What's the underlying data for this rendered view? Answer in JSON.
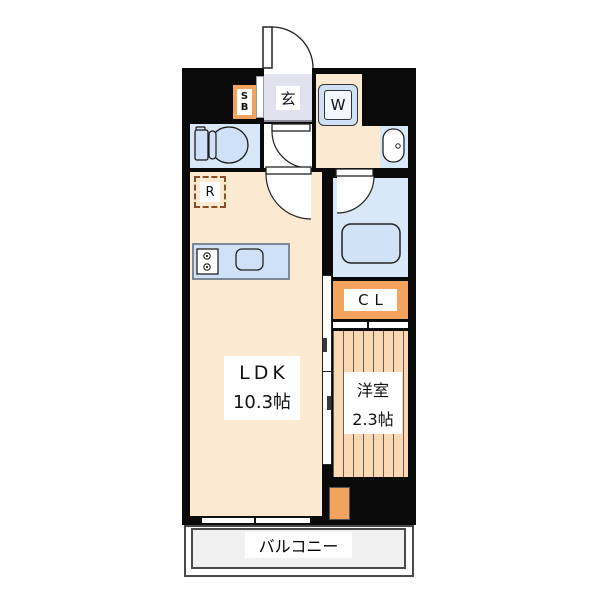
{
  "plan": {
    "type": "apartment-floor-plan",
    "rooms": {
      "entrance": {
        "label": "玄"
      },
      "shoe_box": {
        "line1": "S",
        "line2": "B"
      },
      "washer": {
        "label": "W"
      },
      "refrigerator": {
        "label": "R"
      },
      "closet": {
        "label": "CL"
      },
      "ldk": {
        "label": "LDK",
        "size": "10.3帖"
      },
      "western_room": {
        "label": "洋室",
        "size": "2.3帖"
      },
      "balcony": {
        "label": "バルコニー"
      }
    },
    "colors": {
      "wall": "#0a0a0a",
      "floor_cream": "#fce9d2",
      "water_room_blue": "#d9e8f8",
      "fixture_blue": "#cfe1f6",
      "accent_orange": "#f2a45f",
      "entrance_lavender": "#e2e1ee",
      "balcony_gray": "#f0f0f0",
      "wood_stripe": "#f9d9b3"
    }
  }
}
